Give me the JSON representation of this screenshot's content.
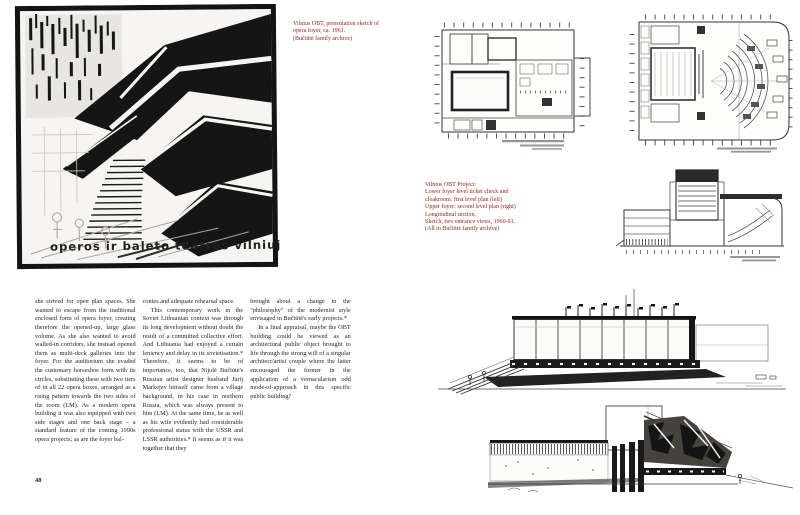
{
  "spread": {
    "colors": {
      "caption_red": "#8e1d13",
      "ink": "#1a1a1a",
      "paper": "#ffffff"
    },
    "left_page": {
      "artwork": {
        "description": "opera foyer presentation sketch",
        "inscription": "operos ir baleto teatras vilniuje"
      },
      "caption": {
        "lines": [
          "Vilnius OBT, presentation sketch of",
          "opera foyer, ca. 1961.",
          "(Bučiūtė family archive)"
        ]
      },
      "body": {
        "col1_p1": "she strived for open plan spaces. She wanted to escape from the traditional enclosed form of opera foyer, creating therefore the opened-up, large glass volume. As she also wanted to avoid walled-in corridors, she instead opened them as multi-deck galleries into the foyer. For the auditorium she evaded the customary horseshoe form with its circles, substituting these with two tiers of in all 22 opera boxes, arranged as a rising pattern towards the two sides of the room (LM). As a modern opera building it was also equipped with two side stages and one back stage – a standard feature of the coming 1990s opera projects; as are the foyer bal-",
        "col2_p1": "conies and adequate rehearsal space.",
        "col2_p2": "This contemporary work in the Soviet Lithuanian context was through its long development without doubt the result of a committed collective effort. And Lithuania had enjoyed a certain leniency and delay in its sovietisation.* Therefore, it seems to be of importance, too, that Nijolė Bučiūtė's Russian artist designer husband Jurij Markejev himself came from a village background, in his case in northern Russia, which was always present to him (LM). At the same time, he as well as his wife evidently had considerable professional status with the USSR and LSSR authorities.* It seems as if it was together that they",
        "col3_p1": "brought about a change in the \"philosophy\" of the modernist style envisaged in Bučiūtė's early projects.*",
        "col3_p2": "In a final appraisal, maybe the OBT building could be viewed as an architectural public object brought to life through the strong will of a singular architect/artist couple where the latter encouraged the former in the application of a vernacularism odd mode-of-approach in this specific public building?"
      },
      "page_number": "48"
    },
    "right_page": {
      "caption": {
        "lines": [
          "Vilnius OBT Project:",
          "Lower foyer level ticket check and",
          "cloakroom: first level plan (left)",
          "Upper foyer: second level plan (right)",
          "Longitudinal section.",
          "Sketch, two entrance views, 1960-61.",
          "(All in Bučiūtė family archive)"
        ]
      },
      "drawings": {
        "first_level_plan": "first level plan",
        "second_level_plan": "second level plan with auditorium",
        "longitudinal_section": "longitudinal section",
        "exterior_sketch": "exterior perspective sketch",
        "rear_sketch": "sketch with mural wall"
      }
    }
  }
}
